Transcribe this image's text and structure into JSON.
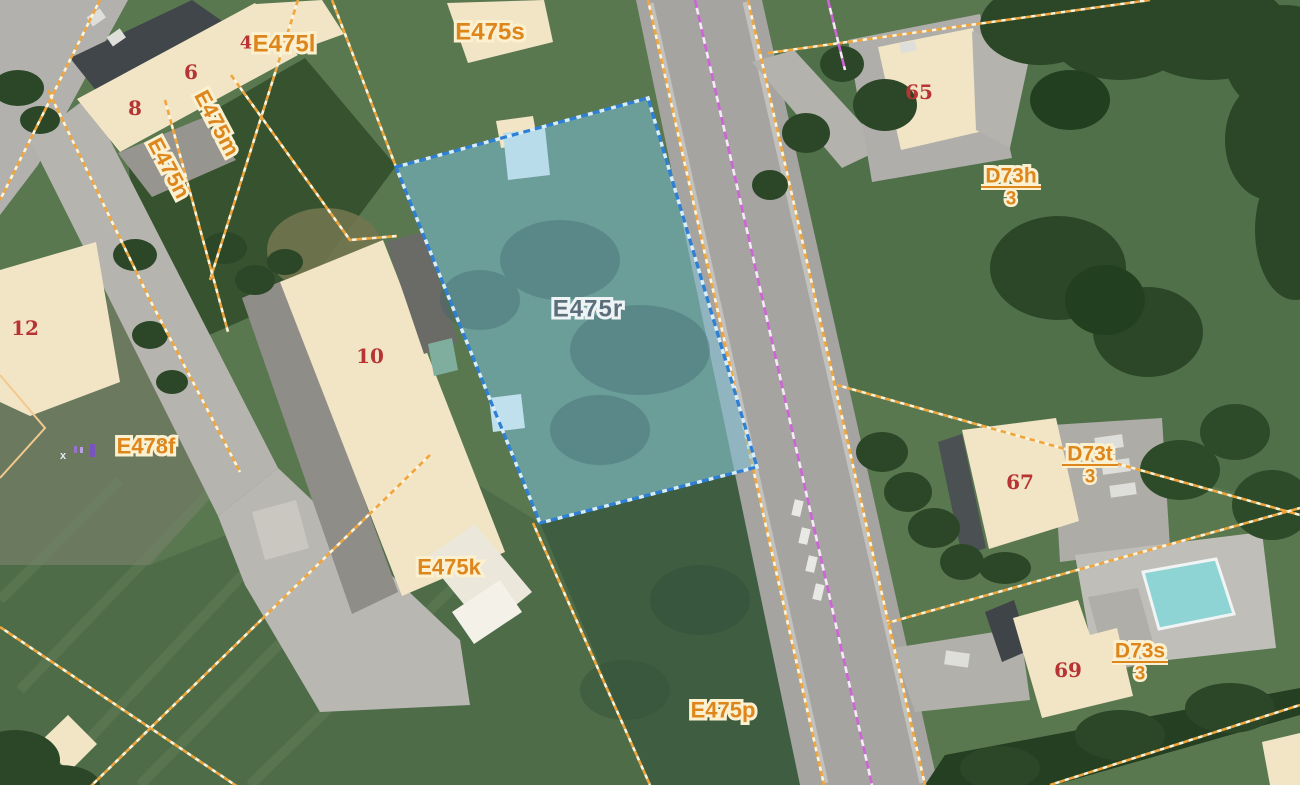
{
  "map": {
    "type": "cadastral-aerial-map",
    "highlighted_parcel": {
      "id": "E475r"
    },
    "parcel_labels": [
      {
        "id": "E475s"
      },
      {
        "id": "E475l",
        "house_no": "4"
      },
      {
        "id": "E475m"
      },
      {
        "id": "E475n"
      },
      {
        "id": "E478f"
      },
      {
        "id": "E475k"
      },
      {
        "id": "E475p"
      }
    ],
    "building_numbers": [
      "6",
      "8",
      "12",
      "10",
      "65",
      "67",
      "69"
    ],
    "fraction_labels": [
      {
        "parcel": "D73h",
        "index": "3"
      },
      {
        "parcel": "D73t",
        "index": "3"
      },
      {
        "parcel": "D73s",
        "index": "3"
      }
    ],
    "survey_marker": {
      "symbol": "x"
    },
    "colors": {
      "parcel_boundary": "#f0a63c",
      "boundary_casing": "#fdf4da",
      "admin_boundary": "#cf63d8",
      "highlight_fill": "#7cc4e0",
      "highlight_border": "#2e7fd6",
      "label_text": "#dd861c",
      "label_halo": "#fbf0d0",
      "building_number": "#b63434",
      "building_fill": "#f2e5c5",
      "selected_label_text": "#5c6e7a",
      "road": "#a5a4a0",
      "grass": "#5a7850",
      "pool": "#8fd4d4"
    }
  }
}
